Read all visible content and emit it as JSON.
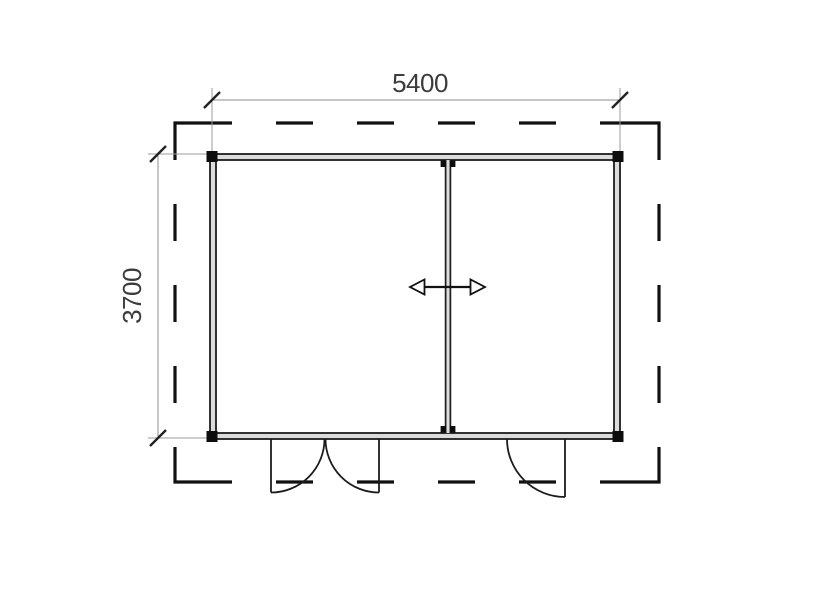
{
  "floor_plan": {
    "dimensions": {
      "width_label": "5400",
      "depth_label": "3700"
    },
    "symbols": {
      "roof_overhang": "dashed-outline",
      "partition_arrow": "double-headed-horizontal-arrow",
      "doors": [
        "double-door-swing-bottom-left",
        "single-door-swing-bottom-right"
      ]
    },
    "colors": {
      "line": "#1c1c1c",
      "dashed_outline": "#111111",
      "dimension_line": "#8c8c8c",
      "dimension_text": "#3c3c3c",
      "wall_fill": "#dcdcdc",
      "background": "#ffffff"
    }
  }
}
